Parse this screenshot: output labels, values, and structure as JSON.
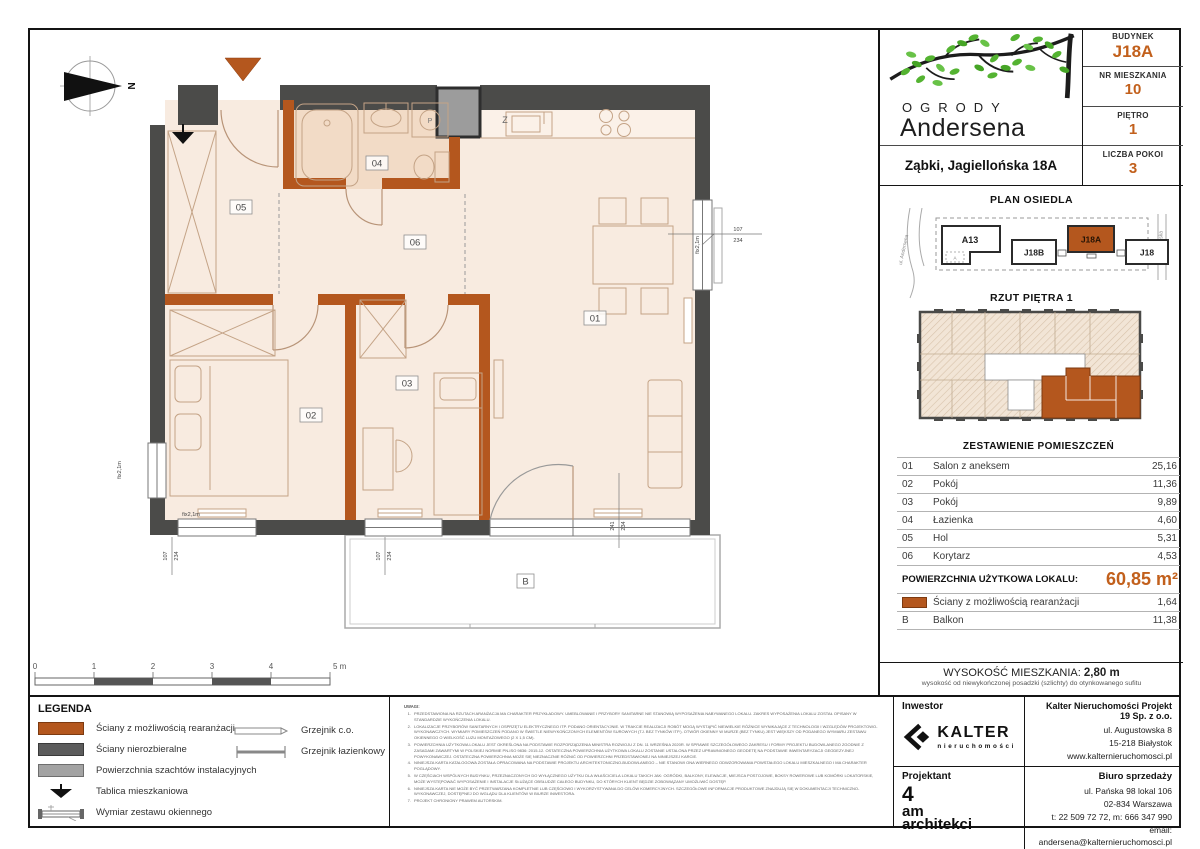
{
  "colors": {
    "accent_orange": "#c2601c",
    "wall_orange": "#b4571e",
    "wall_dark": "#4b4b49",
    "shaft_gray": "#9c9c9c"
  },
  "header": {
    "logo_line1": "OGRODY",
    "logo_line2": "Andersena",
    "address": "Ząbki, Jagiellońska 18A",
    "info": [
      {
        "label": "BUDYNEK",
        "value": "J18A"
      },
      {
        "label": "NR MIESZKANIA",
        "value": "10"
      },
      {
        "label": "PIĘTRO",
        "value": "1"
      },
      {
        "label": "LICZBA POKOI",
        "value": "3"
      }
    ]
  },
  "site_plan": {
    "title": "PLAN OSIEDLA",
    "buildings": [
      "A13",
      "J18B",
      "J18A",
      "J18"
    ],
    "highlight": "J18A",
    "streets": [
      "ul. Andersena",
      "ul. Jagiellońska"
    ],
    "sub_label": "A"
  },
  "floor_plan_mini": {
    "title": "RZUT PIĘTRA 1"
  },
  "rooms": {
    "title": "ZESTAWIENIE POMIESZCZEŃ",
    "rows": [
      {
        "no": "01",
        "name": "Salon z aneksem",
        "area": "25,16"
      },
      {
        "no": "02",
        "name": "Pokój",
        "area": "11,36"
      },
      {
        "no": "03",
        "name": "Pokój",
        "area": "9,89"
      },
      {
        "no": "04",
        "name": "Łazienka",
        "area": "4,60"
      },
      {
        "no": "05",
        "name": "Hol",
        "area": "5,31"
      },
      {
        "no": "06",
        "name": "Korytarz",
        "area": "4,53"
      }
    ],
    "total_label": "POWIERZCHNIA UŻYTKOWA LOKALU:",
    "total_value": "60,85 m²",
    "walls_row": {
      "name": "Ściany z możliwością rearanżacji",
      "area": "1,64"
    },
    "balcony_row": {
      "no": "B",
      "name": "Balkon",
      "area": "11,38"
    }
  },
  "height": {
    "label": "WYSOKOŚĆ MIESZKANIA:",
    "value": "2,80 m",
    "note": "wysokość od niewykończonej posadzki (szlichty) do otynkowanego sufitu"
  },
  "investor": {
    "label": "Inwestor",
    "brand": "KALTER",
    "brand_sub": "nieruchomości",
    "company": "Kalter Nieruchomości Projekt 19 Sp. z o.o.",
    "address_lines": [
      "ul. Augustowska 8",
      "15-218 Białystok",
      "www.kalternieruchomosci.pl"
    ]
  },
  "designer": {
    "label": "Projektant",
    "name_l1": "4",
    "name_l2": "am",
    "name_l3": "architekci"
  },
  "sales_office": {
    "label": "Biuro sprzedaży",
    "lines": [
      "ul. Pańska 98 lokal 106",
      "02-834 Warszawa",
      "t: 22 509 72 72, m: 666 347 990",
      "email: andersena@kalternieruchomosci.pl"
    ]
  },
  "legend": {
    "title": "LEGENDA",
    "items": [
      {
        "label": "Ściany z możliwością rearanżacji"
      },
      {
        "label": "Ściany nierozbieralne"
      },
      {
        "label": "Powierzchnia szachtów instalacyjnych"
      },
      {
        "label": "Tablica mieszkaniowa"
      },
      {
        "label": "Wymiar zestawu okiennego"
      }
    ],
    "right_items": [
      {
        "label": "Grzejnik c.o."
      },
      {
        "label": "Grzejnik łazienkowy"
      }
    ]
  },
  "scale_bar": {
    "ticks": [
      "0",
      "1",
      "2",
      "3",
      "4",
      "5 m"
    ]
  },
  "notes": {
    "title": "UWAGI:",
    "items": [
      "PRZEDSTAWIONA NA RZUTACH ARANŻACJA MA CHARAKTER PRZYKŁADOWY. UMEBLOWANIE I PRZYBORY SANITARNE NIE STANOWIĄ WYPOSAŻENIA NABYWANEGO LOKALU. ZAKRES WYPOSAŻENIA LOKALU ZOSTAŁ OPISANY W STANDARDZIE WYKOŃCZENIA LOKALU.",
      "LOKALIZACJE PRZYBORÓW SANITARNYCH I OSPRZĘTU ELEKTRYCZNEGO ITP. PODANO ORIENTACYJNIE. W TRAKCIE REALIZACJI ROBÓT MOGĄ WYSTĄPIĆ NIEWIELKIE RÓŻNICE WYNIKAJĄCE Z TECHNOLOGII I WZGLĘDÓW PROJEKTOWO-WYKONAWCZYCH. WYMIARY POMIESZCZEŃ PODANO W ŚWIETLE NIEWYKOŃCZONYCH ELEMENTÓW SUROWYCH (TJ. BEZ TYNKÓW ITP.). OTWÓR OKIENNY W MURZE (BEZ TYNKU) JEST WIĘKSZY OD PODANEGO WYMIARU ZESTAWU OKIENNEGO O WIELKOŚĆ LUZU MONTAŻOWEGO (2 X 1,5 CM).",
      "POWIERZCHNIA UŻYTKOWA LOKALU JEST OKREŚLONA NA PODSTAWIE ROZPORZĄDZENIA MINISTRA ROZWOJU Z DN. 11 WRZEŚNIA 2020R. W SPRAWIE SZCZEGÓŁOWEGO ZAKRESU I FORMY PROJEKTU BUDOWLANEGO ZGODNIE Z ZASADAMI ZAWARTYMI W POLSKIEJ NORMIE PN-ISO 9836: 2015-12. OSTATECZNA POWIERZCHNIA UŻYTKOWA LOKALU ZOSTANIE USTALONA PRZEZ UPRAWNIONEGO GEODETĘ NA PODSTAWIE INWENTARYZACJI GEODEZYJNEJ POWYKONAWCZEJ. OSTATECZNA POWIERZCHNIA MOŻE SIĘ NIEZNACZNIE RÓŻNIĆ OD POWIERZCHNI PRZEDSTAWIONEJ NA NINIEJSZEJ KARCIE.",
      "NINIEJSZA KARTA KATALOGOWA ZOSTAŁA OPRACOWANA NA PODSTAWIE PROJEKTU ARCHITEKTONICZNO-BUDOWLANEGO – NIE STANOWI ONA WIERNEGO ODWZOROWANIA POWSTAŁEGO LOKALU MIESZKALNEGO I MA CHARAKTER POGLĄDOWY.",
      "W CZĘŚCIACH WSPÓLNYCH BUDYNKU, PRZEZNACZONYCH DO WYŁĄCZNEGO UŻYTKU DLA WŁAŚCICIELA LOKALU TAKICH JAK: OGRÓDKI, BALKONY, ELEWACJE, MIEJSCA POSTOJOWE, BOKSY ROWEROWE LUB KOMÓRKI LOKATORSKIE, MOŻE WYSTĘPOWAĆ WYPOSAŻENIE I INSTALACJE SŁUŻĄCE OBSŁUDZE CAŁEGO BUDYNKU, DO KTÓRYCH KLIENT BĘDZIE ZOBOWIĄZANY UMOŻLIWIĆ DOSTĘP.",
      "NINIEJSZA KARTA NIE MOŻE BYĆ PRZETWARZANA KOMPLETNIE LUB CZĘŚCIOWO I WYKORZYSTYWANA DO CELÓW KOMERCYJNYCH. SZCZEGÓŁOWE INFORMACJE PRODUKTOWE ZNAJDUJĄ SIĘ W DOKUMENTACJI TECHNICZNO-WYKONAWCZEJ, DOSTĘPNEJ DO WGLĄDU DLA KLIENTÓW W BIURZE INWESTORA.",
      "PROJEKT CHRONIONY PRAWEM AUTORSKIM."
    ]
  },
  "plan": {
    "north_label": "N",
    "room_labels": {
      "r01": "01",
      "r02": "02",
      "r03": "03",
      "r04": "04",
      "r05": "05",
      "r06": "06"
    },
    "balcony_label": "B",
    "kitchen_label": "Z",
    "washer_label": "P",
    "fix_window_label": "fix2,1m",
    "dims": {
      "d107": "107",
      "d234": "234",
      "d241": "241"
    }
  }
}
